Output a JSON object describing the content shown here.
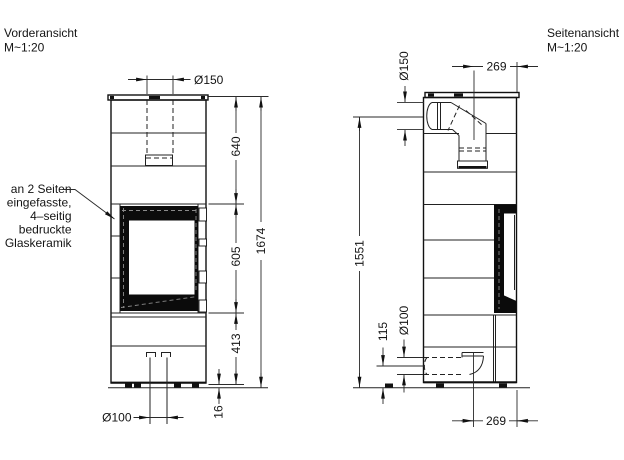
{
  "drawing": {
    "front": {
      "title": "Vorderansicht",
      "scale": "M~1:20",
      "dims": {
        "flue_d": "Ø150",
        "top_h": "640",
        "window_h": "605",
        "base_h": "413",
        "total_h": "1674",
        "feet_h": "16",
        "air_d": "Ø100"
      },
      "note": {
        "line1": "an 2 Seiten",
        "line2": "eingefasste,",
        "line3": "4–seitig",
        "line4": "bedruckte",
        "line5": "Glaskeramik"
      }
    },
    "side": {
      "title": "Seitenansicht",
      "scale": "M~1:20",
      "dims": {
        "flue_d": "Ø150",
        "flue_front": "269",
        "flue_h": "1551",
        "air_h": "115",
        "air_d": "Ø100",
        "air_front": "269"
      }
    }
  }
}
